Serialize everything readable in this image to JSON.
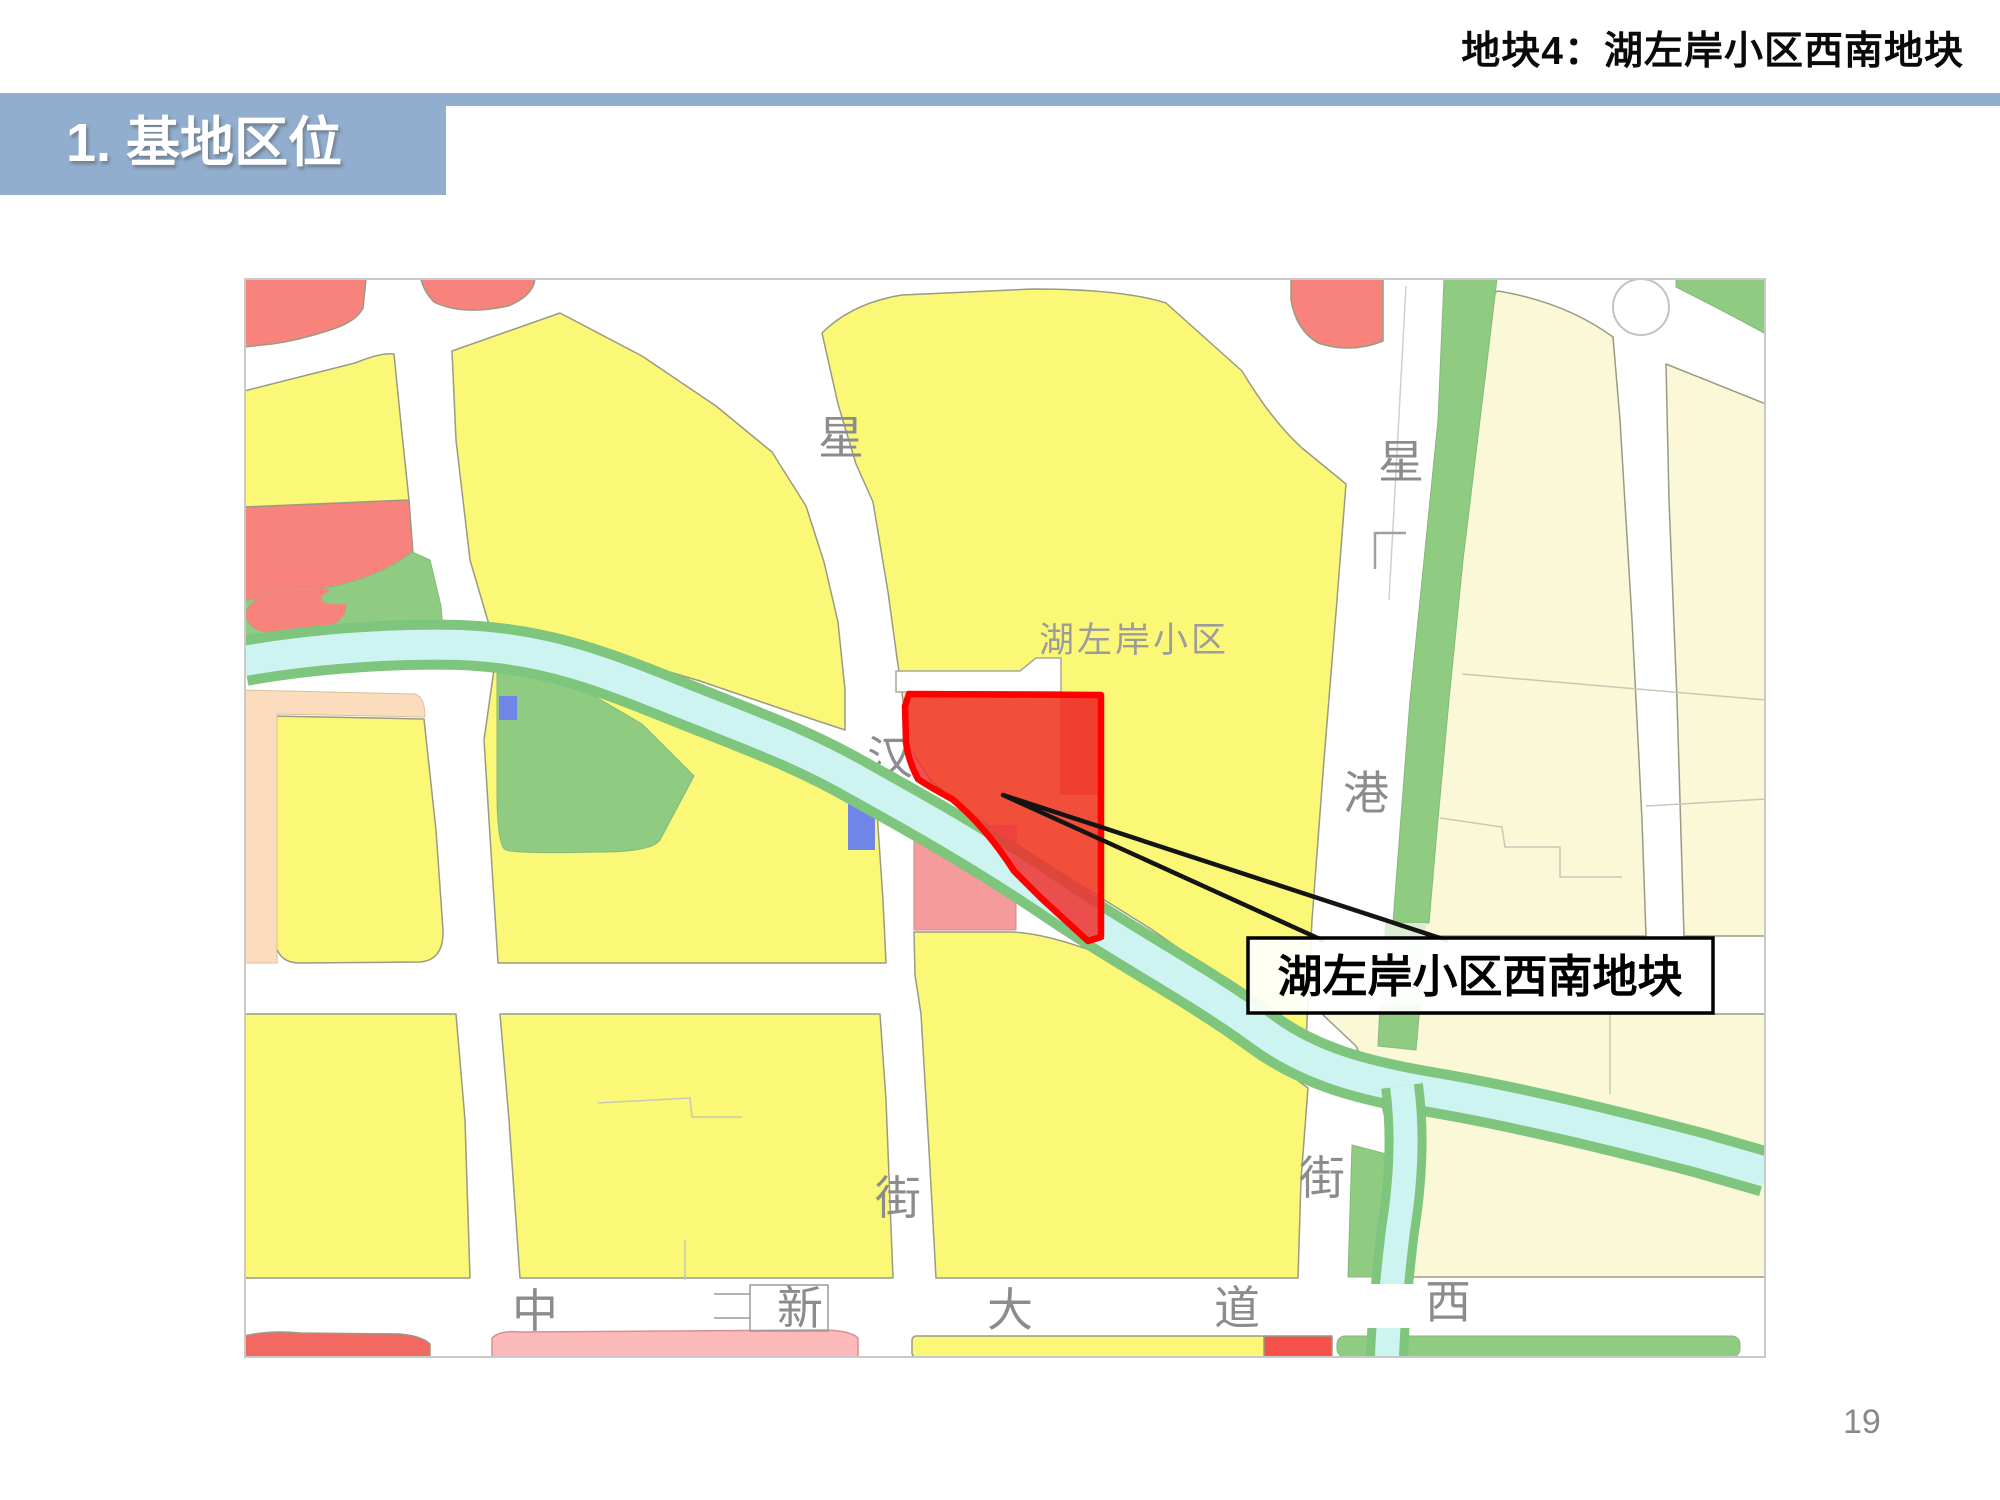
{
  "slide": {
    "header_title": "地块4：湖左岸小区西南地块",
    "section_label": "1. 基地区位",
    "page_number": "19"
  },
  "map": {
    "area_label": "湖左岸小区",
    "callout_label": "湖左岸小区西南地块",
    "road_labels": [
      {
        "text": "星"
      },
      {
        "text": "汉"
      },
      {
        "text": "街"
      },
      {
        "text": "星"
      },
      {
        "text": "港"
      },
      {
        "text": "街"
      },
      {
        "text": "中"
      },
      {
        "text": "新"
      },
      {
        "text": "大"
      },
      {
        "text": "道"
      },
      {
        "text": "西"
      }
    ],
    "colors": {
      "accent_blue": "#92AECE",
      "parcel_yellow": "#FAF876",
      "parcel_pale_yellow": "#FAF8D6",
      "parcel_red": "#F8837C",
      "parcel_green": "#8FCC82",
      "parcel_beige": "#FBDCBC",
      "parcel_pink": "#F69B9B",
      "parcel_orange": "#F0913C",
      "river_water": "#CDF4F1",
      "river_bank": "#7EC57D",
      "water_blue": "#6F86E8",
      "site_fill": "#EF2F2F",
      "site_border": "#FF0000",
      "label_gray": "#8C8C8C"
    }
  }
}
